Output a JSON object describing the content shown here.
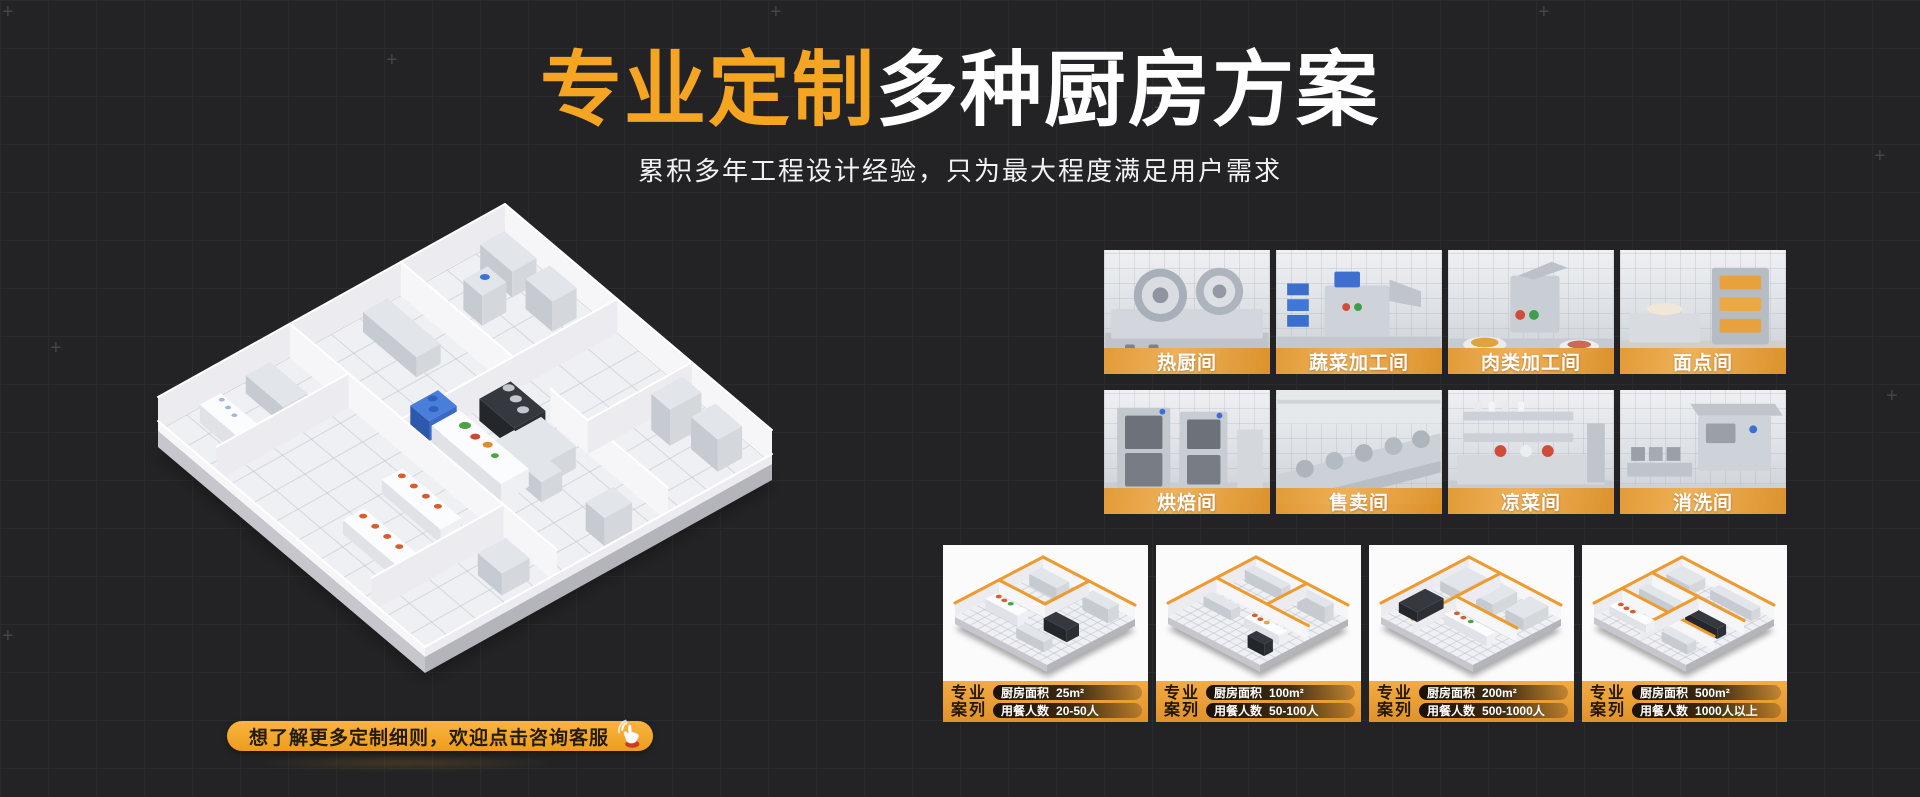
{
  "theme": {
    "background": "#232325",
    "grid_line": "#2B2B2E",
    "accent_orange": "#F6A522",
    "band_orange": "#E89B35",
    "title_white": "#FFFFFF",
    "dark_text": "#231A10"
  },
  "header": {
    "title_highlight": "专业定制",
    "title_rest": "多种厨房方案",
    "subtitle": "累积多年工程设计经验，只为最大程度满足用户需求"
  },
  "cta": {
    "label": "想了解更多定制细则，欢迎点击咨询客服",
    "icon": "click-hand-icon"
  },
  "rooms": [
    {
      "label": "热厨间"
    },
    {
      "label": "蔬菜加工间"
    },
    {
      "label": "肉类加工间"
    },
    {
      "label": "面点间"
    },
    {
      "label": "烘焙间"
    },
    {
      "label": "售卖间"
    },
    {
      "label": "凉菜间"
    },
    {
      "label": "消洗间"
    }
  ],
  "cases": [
    {
      "badge_top": "专业",
      "badge_bottom": "案列",
      "area_label": "厨房面积",
      "area_value": "25m²",
      "diners_label": "用餐人数",
      "diners_value": "20-50人"
    },
    {
      "badge_top": "专业",
      "badge_bottom": "案列",
      "area_label": "厨房面积",
      "area_value": "100m²",
      "diners_label": "用餐人数",
      "diners_value": "50-100人"
    },
    {
      "badge_top": "专业",
      "badge_bottom": "案列",
      "area_label": "厨房面积",
      "area_value": "200m²",
      "diners_label": "用餐人数",
      "diners_value": "500-1000人"
    },
    {
      "badge_top": "专业",
      "badge_bottom": "案列",
      "area_label": "厨房面积",
      "area_value": "500m²",
      "diners_label": "用餐人数",
      "diners_value": "1000人以上"
    }
  ]
}
